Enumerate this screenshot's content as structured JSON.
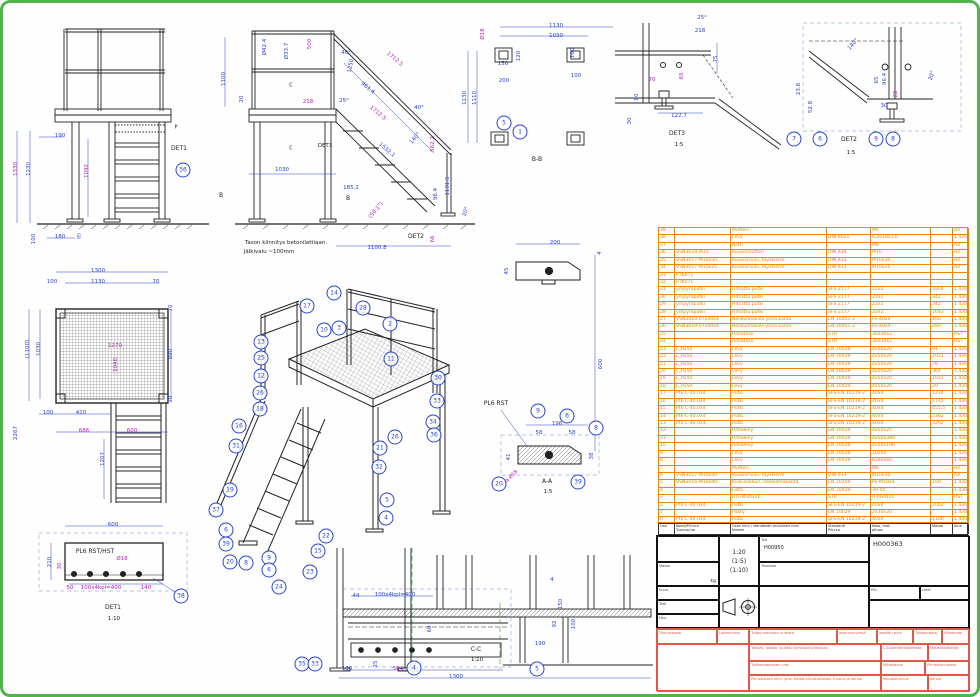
{
  "page": {
    "border_color": "#52b54b",
    "bg": "#fefefe"
  },
  "colors": {
    "b": "#2743cf",
    "m": "#b01fae",
    "k": "#1d1d1d",
    "o": "#e8860c",
    "r": "#d6564a",
    "g": "#2f9e2f"
  },
  "labels": [
    [
      "1330",
      14,
      166,
      "m",
      -90
    ],
    [
      "1230",
      27,
      166,
      "b",
      -90
    ],
    [
      "1092",
      85,
      168,
      "m",
      -90
    ],
    [
      "190",
      57,
      134,
      "b",
      0
    ],
    [
      "100",
      32,
      236,
      "b",
      -90
    ],
    [
      "180",
      57,
      235,
      "b",
      0
    ],
    [
      "85",
      78,
      233,
      "b",
      -90,
      4.5
    ],
    [
      "DET1",
      176,
      146,
      "k",
      0,
      6
    ],
    [
      "P",
      173,
      125,
      "k",
      0,
      5
    ],
    [
      "B",
      218,
      193,
      "k",
      0,
      6
    ],
    [
      "1100",
      222,
      76,
      "b",
      -90
    ],
    [
      "Ø42.4",
      263,
      44,
      "b",
      -90
    ],
    [
      "Ø33.7",
      285,
      48,
      "b",
      -90
    ],
    [
      "500",
      308,
      41,
      "m",
      -90
    ],
    [
      "20",
      240,
      96,
      "b",
      -90
    ],
    [
      "218",
      305,
      100,
      "m",
      0
    ],
    [
      "1250",
      349,
      63,
      "b",
      -80
    ],
    [
      "1712.5",
      391,
      57,
      "m",
      40
    ],
    [
      "961.4",
      364,
      86,
      "b",
      40
    ],
    [
      "1712.5",
      374,
      111,
      "m",
      40
    ],
    [
      "40°",
      343,
      51,
      "b",
      0
    ],
    [
      "25°",
      341,
      99,
      "b",
      0
    ],
    [
      "40°",
      416,
      106,
      "b",
      0
    ],
    [
      "140°",
      413,
      136,
      "b",
      -50
    ],
    [
      "1532.1",
      383,
      148,
      "b",
      40
    ],
    [
      "562.2",
      431,
      141,
      "m",
      -90
    ],
    [
      "1131.5",
      446,
      183,
      "b",
      -90
    ],
    [
      "96.4",
      434,
      191,
      "b",
      -90
    ],
    [
      "185.2",
      348,
      186,
      "b",
      0
    ],
    [
      "1030",
      279,
      168,
      "b",
      0
    ],
    [
      "1100.8",
      374,
      246,
      "b",
      0
    ],
    [
      "(50.1°)",
      374,
      208,
      "m",
      -50
    ],
    [
      "20°",
      464,
      209,
      "b",
      -70
    ],
    [
      "66",
      431,
      236,
      "m",
      -90
    ],
    [
      "DET2",
      413,
      234,
      "k",
      0,
      6
    ],
    [
      "DET3",
      322,
      144,
      "k",
      0,
      5.5
    ],
    [
      "B",
      345,
      196,
      "k",
      0,
      6
    ],
    [
      "C",
      288,
      83,
      "k",
      0,
      5
    ],
    [
      "C",
      288,
      146,
      "k",
      0,
      5
    ],
    [
      "Tason kiinnitys betonilattiaan.",
      283,
      241,
      "k",
      0,
      5.5
    ],
    [
      "Jälkivalu ~100mm",
      266,
      250,
      "k",
      0,
      5.5
    ],
    [
      "1130",
      553,
      24,
      "b",
      0
    ],
    [
      "1030",
      553,
      34,
      "b",
      0
    ],
    [
      "Ø18",
      481,
      31,
      "m",
      -90
    ],
    [
      "120",
      517,
      53,
      "b",
      -90
    ],
    [
      "100",
      571,
      50,
      "b",
      -90
    ],
    [
      "150",
      500,
      62,
      "b",
      0
    ],
    [
      "200",
      501,
      79,
      "b",
      0
    ],
    [
      "100",
      573,
      74,
      "b",
      0
    ],
    [
      "1130",
      463,
      95,
      "b",
      -90
    ],
    [
      "1110",
      473,
      95,
      "b",
      -90
    ],
    [
      "B-B",
      534,
      157,
      "k",
      0,
      6
    ],
    [
      "25°",
      699,
      16,
      "b",
      0
    ],
    [
      "218",
      697,
      29,
      "b",
      0
    ],
    [
      "75",
      714,
      56,
      "b",
      -90
    ],
    [
      "65",
      680,
      73,
      "m",
      -90
    ],
    [
      "70",
      649,
      78,
      "m",
      0
    ],
    [
      "80",
      635,
      94,
      "b",
      -90
    ],
    [
      "30",
      628,
      118,
      "b",
      -90
    ],
    [
      "122.7",
      676,
      114,
      "b",
      0
    ],
    [
      "DET3",
      674,
      131,
      "k",
      0,
      6
    ],
    [
      "1:5",
      676,
      143,
      "k",
      0,
      5.5
    ],
    [
      "140°",
      851,
      42,
      "b",
      -50
    ],
    [
      "23.8",
      797,
      86,
      "b",
      -90
    ],
    [
      "52.8",
      809,
      104,
      "b",
      -90
    ],
    [
      "65",
      875,
      77,
      "b",
      -90
    ],
    [
      "96.4",
      883,
      76,
      "b",
      -90
    ],
    [
      "22",
      894,
      91,
      "m",
      -90
    ],
    [
      "30",
      881,
      104,
      "b",
      0
    ],
    [
      "20°",
      930,
      73,
      "b",
      -70
    ],
    [
      "DET2",
      846,
      137,
      "k",
      0,
      6
    ],
    [
      "1:5",
      848,
      151,
      "k",
      0,
      5.5
    ],
    [
      "1300",
      95,
      269,
      "b",
      0
    ],
    [
      "100",
      49,
      280,
      "b",
      0
    ],
    [
      "1130",
      95,
      280,
      "b",
      0
    ],
    [
      "70",
      153,
      280,
      "b",
      0
    ],
    [
      "70",
      169,
      305,
      "b",
      -90
    ],
    [
      "890",
      169,
      351,
      "b",
      -90
    ],
    [
      "70",
      169,
      396,
      "b",
      -90
    ],
    [
      "(1100)",
      26,
      346,
      "b",
      -90
    ],
    [
      "1030",
      37,
      346,
      "b",
      -90
    ],
    [
      "1270",
      112,
      344,
      "m",
      0
    ],
    [
      "1040",
      114,
      362,
      "m",
      -90
    ],
    [
      "2267",
      14,
      430,
      "b",
      -90
    ],
    [
      "100",
      45,
      411,
      "b",
      0
    ],
    [
      "420",
      78,
      411,
      "b",
      0
    ],
    [
      "686",
      81,
      429,
      "m",
      0
    ],
    [
      "600",
      129,
      429,
      "m",
      0
    ],
    [
      "1207",
      101,
      456,
      "b",
      -90
    ],
    [
      "600",
      110,
      523,
      "b",
      0
    ],
    [
      "210",
      48,
      559,
      "b",
      -90
    ],
    [
      "30",
      58,
      563,
      "m",
      -90
    ],
    [
      "PL6 RST/HST",
      92,
      549,
      "k",
      0,
      6
    ],
    [
      "Ø18",
      119,
      557,
      "m",
      0
    ],
    [
      "50",
      67,
      586,
      "m",
      0
    ],
    [
      "100x4kpl=400",
      98,
      586,
      "m",
      0
    ],
    [
      "140",
      143,
      586,
      "m",
      0
    ],
    [
      "DET1",
      110,
      605,
      "k",
      0,
      6
    ],
    [
      "1:10",
      111,
      617,
      "k",
      0,
      5.5
    ],
    [
      "200",
      552,
      241,
      "b",
      0
    ],
    [
      "45",
      505,
      268,
      "b",
      -90
    ],
    [
      "4",
      598,
      250,
      "b",
      -90
    ],
    [
      "600",
      599,
      361,
      "b",
      -90
    ],
    [
      "PL6 RST",
      493,
      401,
      "k",
      0,
      6
    ],
    [
      "196",
      554,
      422,
      "b",
      0
    ],
    [
      "58",
      536,
      431,
      "b",
      0
    ],
    [
      "58",
      569,
      431,
      "b",
      0
    ],
    [
      "41",
      507,
      454,
      "b",
      -90
    ],
    [
      "38",
      590,
      453,
      "b",
      -90
    ],
    [
      "reikä Ø18",
      506,
      477,
      "m",
      -45,
      5
    ],
    [
      "A-A",
      544,
      479,
      "k",
      0,
      6
    ],
    [
      "1:5",
      545,
      490,
      "k",
      0,
      5.5
    ],
    [
      "44",
      353,
      594,
      "b",
      0
    ],
    [
      "100x4kpl=400",
      392,
      593,
      "b",
      0
    ],
    [
      "4",
      549,
      578,
      "b",
      0
    ],
    [
      "150",
      559,
      601,
      "b",
      -90
    ],
    [
      "92",
      553,
      621,
      "b",
      -90
    ],
    [
      "100",
      572,
      621,
      "b",
      -90
    ],
    [
      "190",
      537,
      642,
      "b",
      0
    ],
    [
      "60",
      428,
      626,
      "b",
      -90
    ],
    [
      "25",
      374,
      661,
      "b",
      -90
    ],
    [
      "100",
      344,
      667,
      "b",
      0
    ],
    [
      "504",
      395,
      667,
      "m",
      0
    ],
    [
      "1300",
      453,
      675,
      "b",
      0
    ],
    [
      "C-C",
      473,
      647,
      "k",
      0,
      6
    ],
    [
      "1:10",
      474,
      658,
      "k",
      0,
      5.5
    ]
  ],
  "balloons": [
    [
      "36",
      180,
      167
    ],
    [
      "5",
      501,
      120
    ],
    [
      "1",
      517,
      129
    ],
    [
      "7",
      791,
      136
    ],
    [
      "6",
      817,
      136
    ],
    [
      "9",
      873,
      136
    ],
    [
      "8",
      890,
      136
    ],
    [
      "38",
      178,
      593
    ],
    [
      "9",
      535,
      408
    ],
    [
      "6",
      564,
      413
    ],
    [
      "8",
      593,
      425
    ],
    [
      "20",
      496,
      481
    ],
    [
      "39",
      575,
      479
    ],
    [
      "4",
      411,
      665
    ],
    [
      "5",
      534,
      666
    ],
    [
      "35",
      299,
      661
    ],
    [
      "33",
      312,
      661
    ],
    [
      "17",
      304,
      303
    ],
    [
      "14",
      331,
      290
    ],
    [
      "28",
      360,
      305
    ],
    [
      "2",
      387,
      321
    ],
    [
      "10",
      321,
      327
    ],
    [
      "3",
      336,
      325
    ],
    [
      "13",
      258,
      339
    ],
    [
      "25",
      258,
      355
    ],
    [
      "11",
      388,
      356
    ],
    [
      "30",
      435,
      375
    ],
    [
      "12",
      258,
      373
    ],
    [
      "26",
      257,
      390
    ],
    [
      "18",
      257,
      406
    ],
    [
      "33",
      434,
      398
    ],
    [
      "34",
      430,
      419
    ],
    [
      "36",
      431,
      432
    ],
    [
      "16",
      236,
      423
    ],
    [
      "31",
      233,
      443
    ],
    [
      "26",
      392,
      434
    ],
    [
      "21",
      377,
      445
    ],
    [
      "32",
      376,
      464
    ],
    [
      "19",
      227,
      487
    ],
    [
      "37",
      213,
      507
    ],
    [
      "6",
      223,
      527
    ],
    [
      "39",
      223,
      541
    ],
    [
      "20",
      227,
      559
    ],
    [
      "8",
      243,
      560
    ],
    [
      "9",
      266,
      555
    ],
    [
      "6",
      266,
      567
    ],
    [
      "24",
      276,
      584
    ],
    [
      "23",
      307,
      569
    ],
    [
      "15",
      315,
      548
    ],
    [
      "22",
      323,
      533
    ],
    [
      "5",
      384,
      497
    ],
    [
      "4",
      383,
      515
    ]
  ],
  "bom": {
    "col_widths": [
      16,
      56,
      96,
      44,
      60,
      22,
      16
    ],
    "headers": [
      "Osa",
      "Koodi/Piir.nro\nTunnus/nro",
      "Osan nimi / standardin mukainen nimi\nNimike",
      "Standardi\nPiir.nro",
      "Koko, mat.\npituus",
      "Massa",
      "Aine"
    ],
    "rows": [
      [
        "39",
        "",
        "Mutteri",
        "",
        "M6",
        "",
        "A4"
      ],
      [
        "38",
        "",
        "Levy",
        "DIN 9021",
        "6,4x18x1,6",
        "",
        "1.4301"
      ],
      [
        "37",
        "",
        "Niitti",
        "",
        "M6",
        "",
        "A4"
      ],
      [
        "36",
        "VSN3024-M10",
        "Kuusiomutteri",
        "DIN 934",
        "M10",
        "",
        "A4"
      ],
      [
        "35",
        "VSN3017-M10x30",
        "Kuusioruuvi, täyskierre",
        "DIN 933",
        "M10x30",
        "",
        "A4"
      ],
      [
        "34",
        "VSN3017-M10x25",
        "Kuusioruuvi, täyskierre",
        "DIN 933",
        "M10x25",
        "",
        "A4"
      ],
      [
        "33",
        "PTK071",
        "",
        "",
        "",
        "",
        ""
      ],
      [
        "32",
        "PTK071",
        "",
        "",
        "",
        "",
        ""
      ],
      [
        "31",
        "ympyräputki",
        "Hitsattu putki",
        "SFS 2177",
        "22x2",
        "1864",
        "1.4301"
      ],
      [
        "30",
        "ympyräputki",
        "Hitsattu putki",
        "SFS 2177",
        "22x2",
        "342",
        "1.4301"
      ],
      [
        "29",
        "ympyräputki",
        "Hitsattu putki",
        "SFS 2177",
        "22x2",
        "342",
        "1.4301"
      ],
      [
        "28",
        "ympyräputki",
        "Hitsattu putki",
        "SFS 2177",
        "22x2",
        "1643",
        "1.4301"
      ],
      [
        "27",
        "VSN3019-07x40x4",
        "Nelikulmakiila ynnä kanta",
        "EN 10051-2",
        "Pv-40x4",
        "400",
        "1.4301"
      ],
      [
        "26",
        "VSN3019-07x40x4",
        "Nelikulmakiila ynnä kanta",
        "EN 10051-2",
        "Pv-40x4",
        "280",
        "1.4301"
      ],
      [
        "25",
        "",
        "Ritilätaso",
        "STR",
        "30x30x2",
        "",
        "RST"
      ],
      [
        "24",
        "",
        "Ritilätaso",
        "STR",
        "30x30x2",
        "",
        "RST"
      ],
      [
        "23",
        "L_Pu50",
        "Levy",
        "EN 10029",
        "4x50x20",
        "94",
        "1.4301"
      ],
      [
        "22",
        "L_Pu50",
        "Levy",
        "EN 10029",
        "4x50x20",
        "1021",
        "1.4301"
      ],
      [
        "21",
        "L_Pu50",
        "Levy",
        "EN 10029",
        "4x50x20",
        "78",
        "1.4301"
      ],
      [
        "20",
        "L_Pu50",
        "Levy",
        "EN 10029",
        "4x50x20",
        "364",
        "1.4301"
      ],
      [
        "19",
        "L_Pu50",
        "Levy",
        "EN 10029",
        "4x50x20",
        "1021",
        "1.4301"
      ],
      [
        "18",
        "L_Pu50",
        "Levy",
        "EN 10029",
        "4x50x20",
        "20",
        "1.4301"
      ],
      [
        "17",
        "Ptk-C-40.0x4",
        "Putki",
        "SFS-EN 10219-2",
        "40x4",
        "1234",
        "1.4301"
      ],
      [
        "16",
        "Ptk-C-40.0x4",
        "Putki",
        "SFS-EN 10219-2",
        "40x4",
        "1745",
        "1.4301"
      ],
      [
        "15",
        "Ptk-C-40.0x4",
        "Putki",
        "SFS-EN 10219-2",
        "40x4",
        "455,5",
        "1.4301"
      ],
      [
        "14",
        "Ptk-C-40.0x4",
        "Putki",
        "SFS-EN 10219-2",
        "40x4",
        "2362",
        "1.4301"
      ],
      [
        "13",
        "Ptk-C-40.0x4",
        "Putki",
        "SFS-EN 10219-2",
        "40x4",
        "3262",
        "1.4301"
      ],
      [
        "12",
        "",
        "Ritilälevy",
        "EN 10029",
        "4x50x25",
        "",
        "1.4301"
      ],
      [
        "11",
        "",
        "Ritilälevy",
        "EN 10029",
        "4x50x380",
        "",
        "1.4301"
      ],
      [
        "10",
        "",
        "Ritilälevy",
        "EN 10029",
        "4x50x190",
        "",
        "1.4301"
      ],
      [
        "9",
        "",
        "Levy",
        "EN 10029",
        "10x60",
        "",
        "1.4301"
      ],
      [
        "8",
        "",
        "Levy",
        "EN 10029",
        "6x60x60",
        "",
        "1.4301"
      ],
      [
        "7",
        "",
        "Mutteri",
        "",
        "M6",
        "",
        "A4"
      ],
      [
        "6",
        "VSN3017-M10x30",
        "Kuusioruuvi, täyskierre",
        "DIN 933",
        "M10x30",
        "",
        "A4"
      ],
      [
        "5",
        "VSN3015-M10x40",
        "Kiila-ankkuri, nelikulmakanta",
        "EN 10259",
        "Pv-M10x4",
        "100",
        "1.4301"
      ],
      [
        "4",
        "",
        "Lista",
        "EN 10029",
        "30-50",
        "",
        "1.4301"
      ],
      [
        "3",
        "",
        "RTL-W30x20",
        "STR",
        "H30xW20",
        "",
        "RST"
      ],
      [
        "2",
        "Ptk-C-40.0x4",
        "Putki",
        "SFS-EN 10219-2",
        "40x4",
        "2062",
        "1.4301"
      ],
      [
        "1",
        "",
        "Pääty",
        "EN 10029",
        "2x30x20",
        "",
        "1.4301"
      ],
      [
        "0",
        "Ptk-C-40.0x4",
        "Putki",
        "SFS-EN 10219-2",
        "40x4",
        "1100",
        "1.4301"
      ]
    ]
  },
  "title_block": {
    "scale_main": "1:20",
    "scale_alt1": "(1:5)",
    "scale_alt2": "(1:10)",
    "drawing_number": "H000363",
    "work_label": "Työ",
    "work_value": "H00950",
    "mass_label": "Massa",
    "mass_unit": "kg",
    "sign_row1": "Suun.",
    "sign_row2": "Tark.",
    "sign_row3": "Hyv.",
    "piir_label": "Piir.",
    "sheet_label": "Lehti",
    "file_label": "Tiedosto"
  },
  "red_form": {
    "top_widths": [
      60,
      32,
      88,
      40,
      36,
      29,
      28
    ],
    "top_cells": [
      "Tunnuskoodi",
      "Laitetunnus",
      "Työpiirustuksen numero",
      "asennusryhmä",
      "laadittu pvm",
      "Työkohdetta",
      "Viitetiedot"
    ],
    "cell_a": "Tehdas, osasto (uusittu korvaava piirustus)",
    "cell_b": "Työkohtapisteen nimi",
    "cell_c": "Piirustuksen nimi, yms. tiedot piirustuksesta, tunnus ja versio",
    "cell_d": "L.Suunnittelutoimisto",
    "cell_e": "Materiaalitiedot",
    "cell_f": "Mittakaava",
    "cell_g": "Piirustusnumero",
    "cell_h": "Muutostunnus",
    "cell_i": "Versio"
  }
}
